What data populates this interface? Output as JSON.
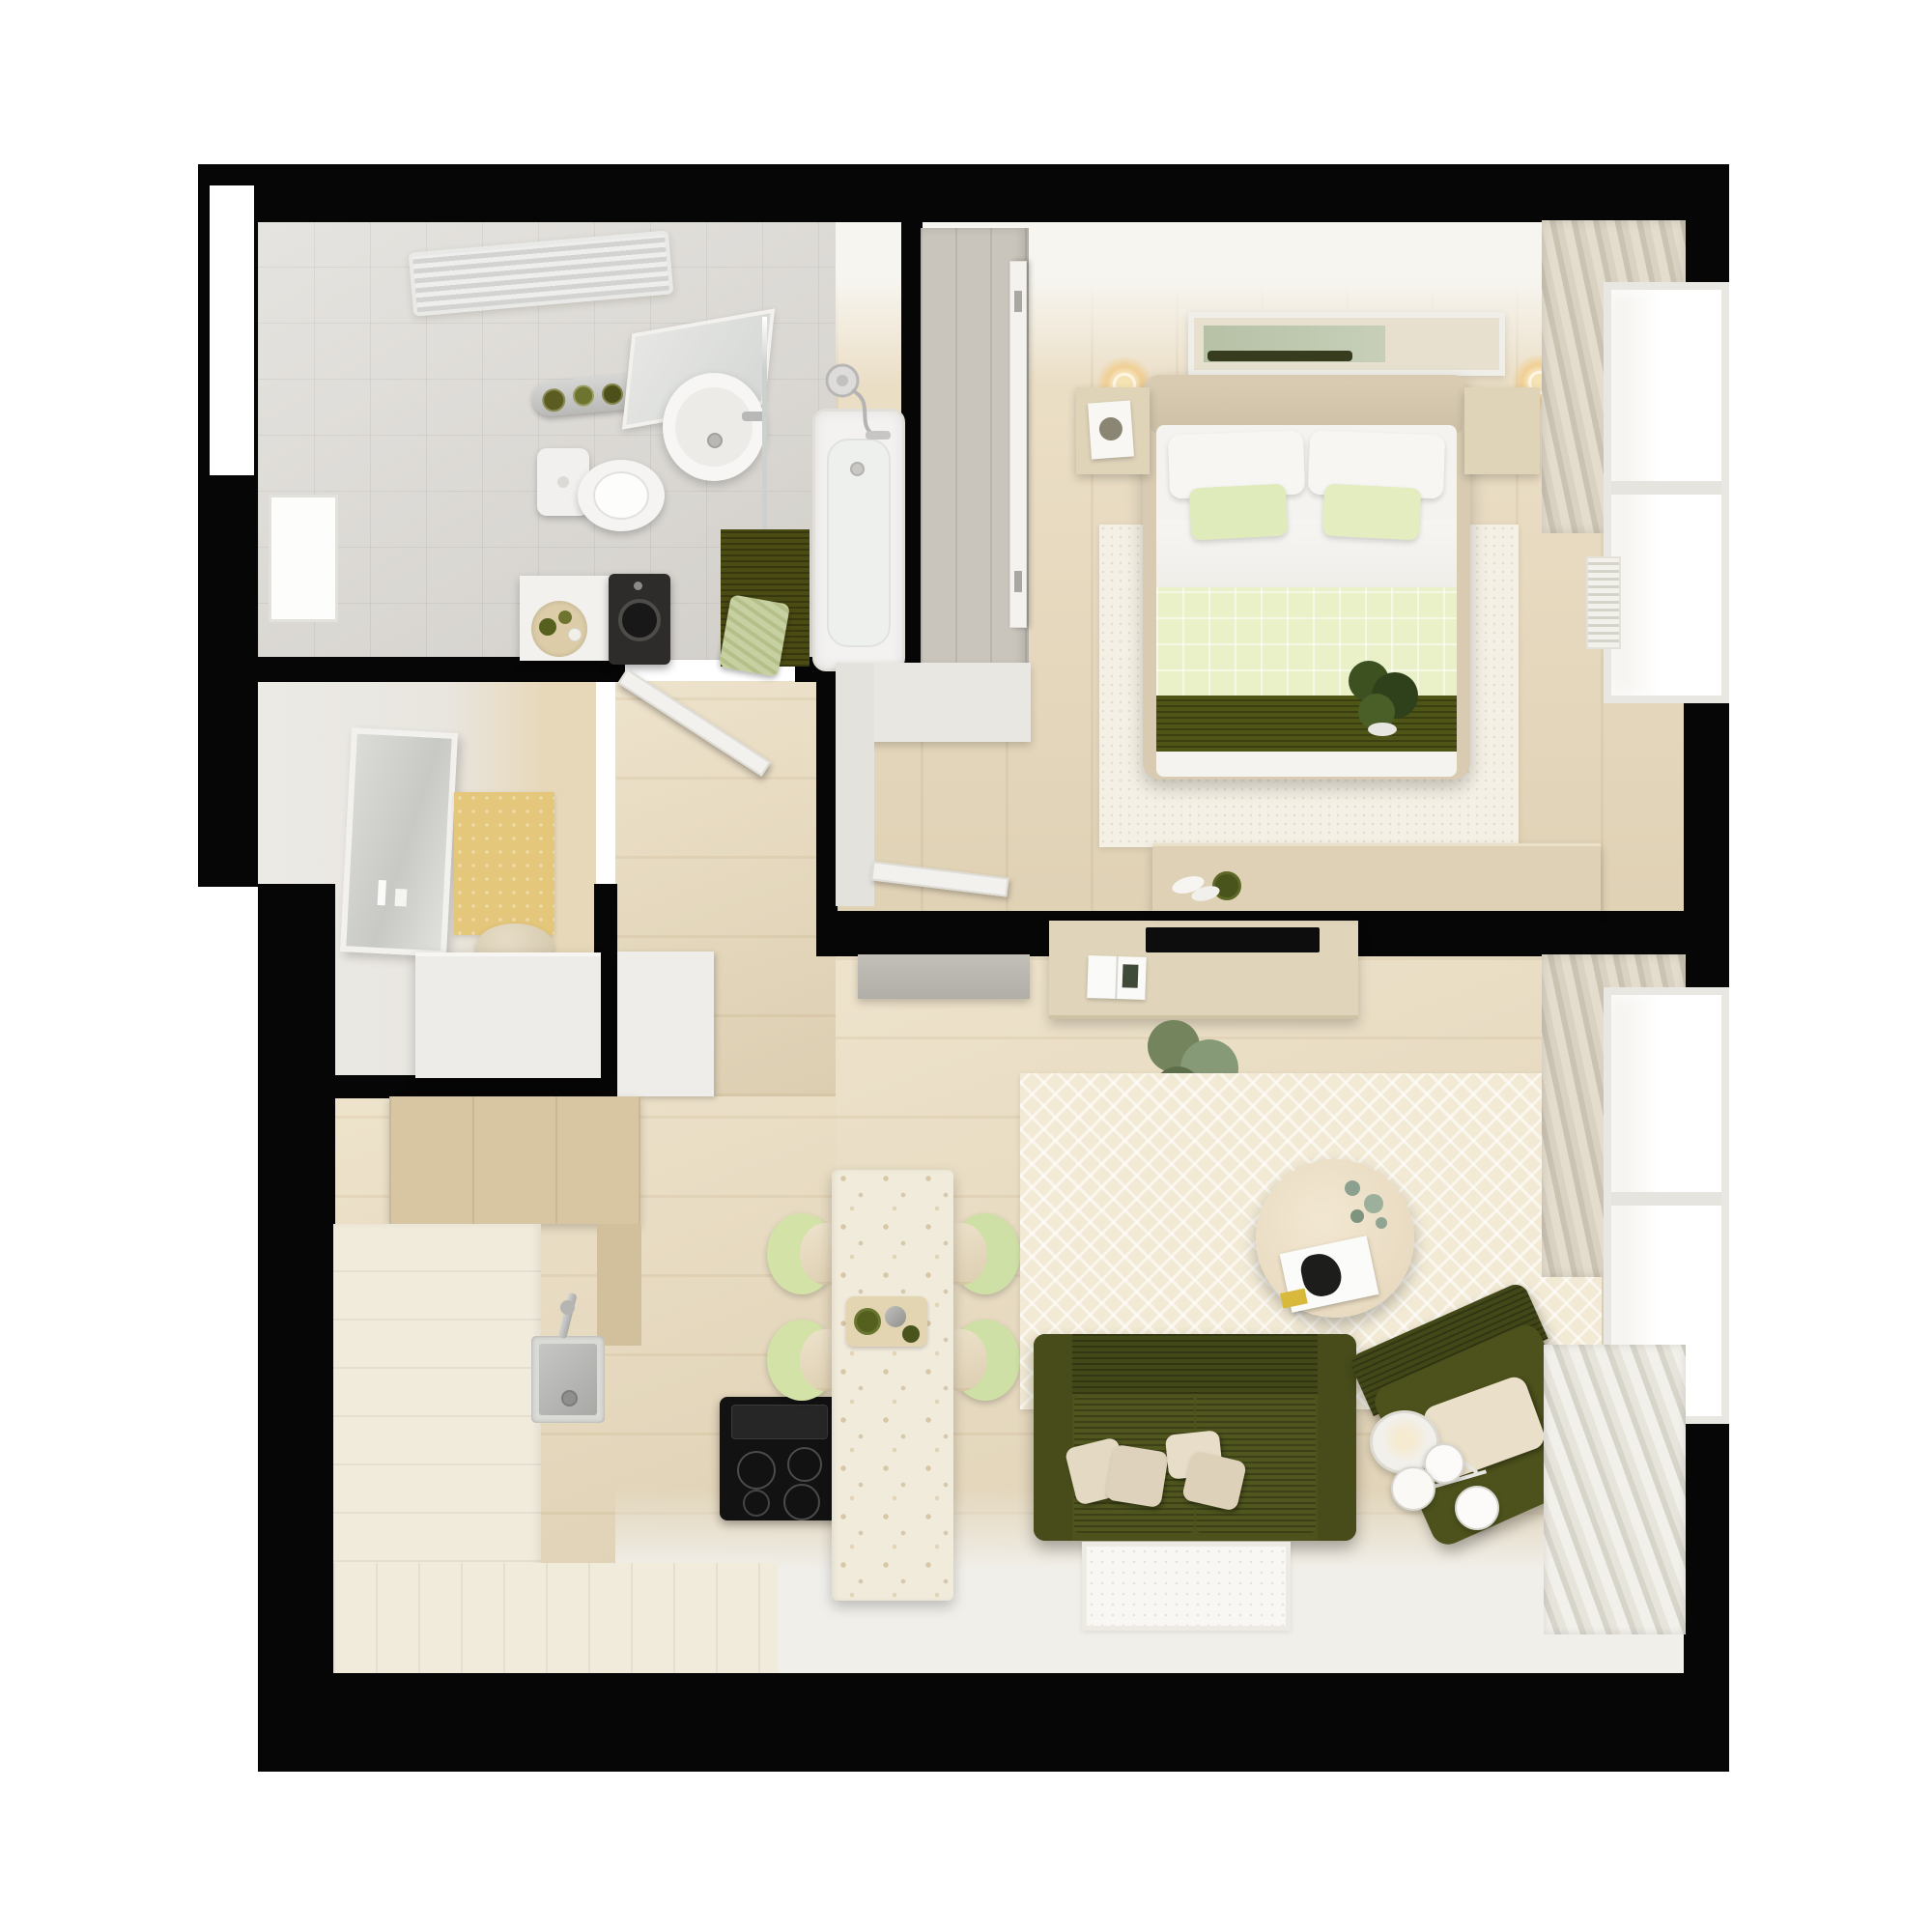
{
  "scene": {
    "kind": "top-down 3D interior render",
    "subject": "one-bedroom apartment floor plan",
    "background": "#ffffff",
    "wall_color": "#060606"
  },
  "palette": {
    "wood_floor": "#e9dabc",
    "bath_tile": "#dcd9d4",
    "terrazzo": "#f1ebdc",
    "olive": "#4d521c",
    "olive_dark": "#434818",
    "olive_runner": "#4f5517",
    "pale_green": "#dfeab8",
    "quilt_green": "#eaf1c8",
    "chair_green": "#d3e3a8",
    "cream_rug": "#f2ead5",
    "beige_furniture": "#ddd0b5",
    "tan_cabinet": "#d8c6a3",
    "hall_rug_yellow": "#e5c77b",
    "lamp_glow": "#f0cf93",
    "cushion_beige": "#e4dac4"
  },
  "rooms": {
    "bathroom": {
      "label": "Bathroom",
      "items": [
        "towel radiator",
        "toiletries shelf",
        "toilet",
        "washbasin with mirror",
        "glass shower screen",
        "bathtub with hand shower",
        "olive bath mat",
        "green towel",
        "side table with tray",
        "washing machine"
      ]
    },
    "hallway": {
      "label": "Entry hall",
      "items": [
        "front door",
        "leaning mirror",
        "yellow rug",
        "pouf",
        "shoe cabinet"
      ]
    },
    "corridor": {
      "label": "Corridor",
      "items": [
        "bathroom door",
        "bedroom nook wardrobe",
        "open door leaf"
      ]
    },
    "bedroom": {
      "label": "Bedroom",
      "items": [
        "built-in wardrobe",
        "open door",
        "framed artwork",
        "two wall lamps",
        "double bed with olive runner",
        "white and green pillows",
        "two nightstands",
        "book",
        "area rug",
        "desk with bowl",
        "potted plant",
        "curtained window",
        "radiator"
      ]
    },
    "kitchen": {
      "label": "Kitchen",
      "items": [
        "tall tan cabinets",
        "L-shaped white counter",
        "steel sink with faucet",
        "induction cooktop with hood"
      ]
    },
    "dining": {
      "label": "Dining nook",
      "items": [
        "terrazzo peninsula table",
        "serving tray with cups",
        "four pale-green chairs"
      ]
    },
    "living": {
      "label": "Living room",
      "items": [
        "grey wall bench",
        "tv console",
        "flat tv",
        "open magazine",
        "potted plant",
        "chevron rug",
        "round coffee table with plant and magazine",
        "olive two-seat sofa",
        "four beige cushions",
        "olive armchair with cushion",
        "white multi-globe floor lamp",
        "white floor mat",
        "curtained windows",
        "long radiator"
      ]
    }
  }
}
